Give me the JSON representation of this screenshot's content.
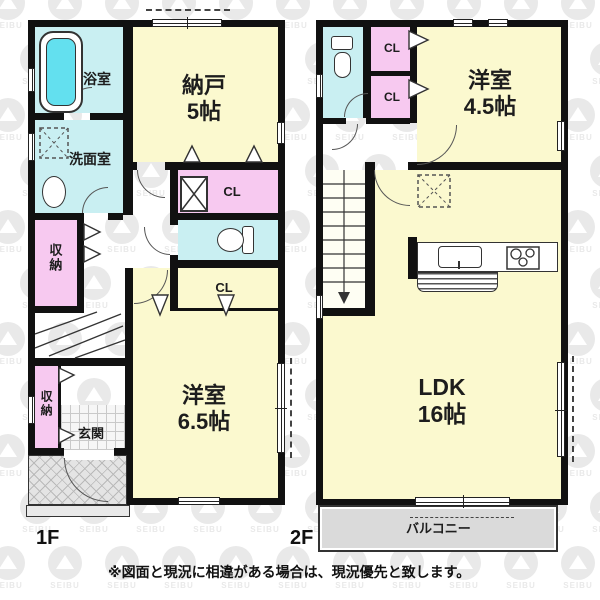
{
  "watermark_text": "SEIBU",
  "colors": {
    "room_yellow": "#FBF9CF",
    "wet_cyan": "#C9EFF2",
    "closet_pink": "#F7C9F0",
    "balcony_gray": "#DADADA",
    "wall_black": "#111111",
    "tub_water": "#63E0EF",
    "wm_gray": "#e9e9e9"
  },
  "f1": {
    "floor_label": "1F",
    "bath": "浴室",
    "washroom": "洗面室",
    "storage_room_name": "納戸",
    "storage_room_size": "5帖",
    "closet1": "CL",
    "closet2": "CL",
    "storage1": "収納",
    "storage2": "収納",
    "entrance": "玄関",
    "western_name": "洋室",
    "western_size": "6.5帖"
  },
  "f2": {
    "floor_label": "2F",
    "closet_a": "CL",
    "closet_b": "CL",
    "western_name": "洋室",
    "western_size": "4.5帖",
    "ldk_name": "LDK",
    "ldk_size": "16帖",
    "balcony": "バルコニー"
  },
  "note": "※図面と現況に相違がある場合は、現況優先と致します。"
}
